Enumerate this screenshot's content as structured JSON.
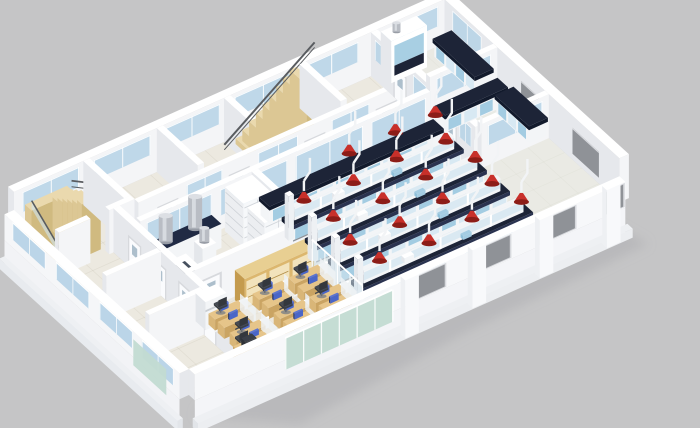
{
  "scene": {
    "type": "3d-isometric-floorplan-render",
    "setting": "laboratory-building-floor",
    "background": "#c5c5c6",
    "areas": [
      {
        "name": "main-laboratory",
        "contents": "4 island benches and 1 wall bench with dark worktops, blue base cabinet panels, reagent shelves, 19 red fume-extractor arms on white drop poles"
      },
      {
        "name": "right-lab-rooms",
        "contents": "two partitioned rooms with wall benches and a fume hood cabinet"
      },
      {
        "name": "prep-room",
        "contents": "counters with stainless extraction ducts, white storage shelving, sink counter"
      },
      {
        "name": "open-office",
        "contents": "12 cubicle desks with blue monitors and dark chairs, wooden glass-door cabinets, copier, corner workstation"
      },
      {
        "name": "circulation",
        "contents": "switchback staircase at left, straight staircase at back, corridors with glazed partition walls"
      },
      {
        "name": "envelope",
        "contents": "white exterior walls with clerestory glazing strips, gray window openings, green curtain-glass section, pilasters and plinth"
      }
    ]
  },
  "palette": {
    "bg": "#c5c5c6",
    "shadow": "#aeafb2",
    "floor": "#ece9e0",
    "tile": "#b9b4a4",
    "wallTop": "#ffffff",
    "wallA": "#f4f5f7",
    "wallB": "#e6e8ec",
    "wallC": "#d8dbe0",
    "glass": "#b5d2e6",
    "glassPale": "#cfe4f0",
    "glassGreen": "#c2dbd2",
    "benchTop": "#1d2437",
    "benchDark": "#121a2c",
    "benchSide": "#2a3350",
    "panelBlue": "#a3cce2",
    "panelBlue2": "#d8e9f3",
    "white": "#f3f5f7",
    "whiteB": "#e4e7eb",
    "red": "#c8302a",
    "redDark": "#8c1d18",
    "wood": "#ead9ae",
    "woodB": "#dcc794",
    "woodC": "#d0ba80",
    "desk": "#e6c58a",
    "deskB": "#caa463",
    "deskC": "#d9b678",
    "cab": "#dcb76e",
    "cabB": "#c49b4e",
    "cabPane": "#f3e6c2",
    "monitor": "#4a66c8",
    "monitorB": "#2c3a66",
    "monitorC": "#5a74d2",
    "chair": "#454a52",
    "chairB": "#33373d",
    "steel": "#b9bdc4",
    "steelB": "#dcdfe4",
    "steelC": "#989da6",
    "winGray": "#8f9297",
    "frame": "#d7d9dd",
    "rail": "#595c60",
    "doorWin": "#a9bcc9"
  },
  "render": {
    "meta": {
      "origin": [
        14,
        236
      ],
      "axisX": [
        1.05,
        -0.47
      ],
      "axisY": [
        0.66,
        0.6
      ],
      "W": 410,
      "D": 265,
      "wallH": 44,
      "lowH": 26,
      "ground": -26
    },
    "items": [
      {
        "t": "shadow",
        "name": "ground-shadow"
      },
      {
        "t": "floor",
        "name": "floor-slab"
      },
      {
        "t": "tint",
        "name": "corridor-floor",
        "x": 72,
        "y": 74,
        "w": 268,
        "d": 16,
        "c": "#efe9da",
        "o": 0.55
      },
      {
        "t": "tint",
        "name": "lab-floor",
        "x": 166,
        "y": 96,
        "w": 244,
        "d": 169,
        "c": "#e8ebe7",
        "o": 0.5
      },
      {
        "t": "tint",
        "name": "right-rooms-floor",
        "x": 340,
        "y": 0,
        "w": 70,
        "d": 158,
        "c": "#e8ebe7",
        "o": 0.5
      },
      {
        "t": "tint",
        "name": "office-floor",
        "x": 52,
        "y": 182,
        "w": 116,
        "d": 83,
        "c": "#ece8db",
        "o": 0.5
      },
      {
        "t": "wallx",
        "name": "back-wall",
        "x0": 0,
        "x1": 410,
        "y": 0,
        "th": 9,
        "glass": [
          [
            8,
            62
          ],
          [
            76,
            130
          ],
          [
            142,
            196
          ],
          [
            210,
            264
          ],
          [
            276,
            328
          ],
          [
            342,
            404
          ]
        ],
        "gz": [
          20,
          40
        ]
      },
      {
        "t": "wally",
        "name": "right-wall",
        "x": 410,
        "th": 9,
        "y0": 0,
        "y1": 265,
        "glass": [
          [
            12,
            56
          ]
        ],
        "gz": [
          20,
          40
        ],
        "win": [
          [
            116,
            156
          ],
          [
            194,
            234
          ]
        ],
        "winz": [
          6,
          32
        ]
      },
      {
        "t": "ustair",
        "name": "switchback-staircase",
        "x": 8,
        "y": 6
      },
      {
        "t": "wally",
        "name": "stair-hall-wall",
        "x": 66,
        "th": 6,
        "y0": 0,
        "y1": 62
      },
      {
        "t": "wallx",
        "name": "stair-hall-front-wall",
        "x0": 0,
        "x1": 30,
        "y": 68,
        "th": 6
      },
      {
        "t": "wallx",
        "name": "stair-hall-front-wall-2",
        "x0": 48,
        "x1": 72,
        "y": 68,
        "th": 6
      },
      {
        "t": "wally",
        "name": "back-room-wall-a",
        "x": 136,
        "th": 6,
        "y0": 0,
        "y1": 62
      },
      {
        "t": "wally",
        "name": "back-room-wall-b",
        "x": 200,
        "th": 6,
        "y0": 0,
        "y1": 62
      },
      {
        "t": "stairs",
        "name": "straight-staircase",
        "x": 206,
        "y": 8,
        "w": 58,
        "d": 26,
        "n": 9,
        "h": 50
      },
      {
        "t": "wally",
        "name": "back-room-wall-c",
        "x": 272,
        "th": 6,
        "y0": 0,
        "y1": 62
      },
      {
        "t": "wallx",
        "name": "corridor-wall-north",
        "x0": 72,
        "x1": 340,
        "y": 74,
        "th": 6,
        "doors": [
          100,
          168,
          240,
          308
        ],
        "glass": [
          [
            118,
            152
          ],
          [
            186,
            224
          ],
          [
            256,
            292
          ],
          [
            318,
            336
          ]
        ],
        "gz": [
          22,
          40
        ]
      },
      {
        "t": "wally",
        "name": "right-lab-partition",
        "x": 340,
        "th": 6,
        "y0": 0,
        "y1": 158,
        "doors": [
          44,
          120
        ],
        "glass": [
          [
            6,
            28
          ],
          [
            64,
            102
          ],
          [
            134,
            152
          ]
        ],
        "gz": [
          20,
          40
        ]
      },
      {
        "t": "wallx",
        "name": "right-room-divider",
        "x0": 346,
        "x1": 410,
        "y": 80,
        "th": 6,
        "glass": [
          [
            352,
            404
          ]
        ],
        "gz": [
          20,
          40
        ]
      },
      {
        "t": "wallx",
        "name": "right-room-south-wall",
        "x0": 346,
        "x1": 410,
        "y": 158,
        "th": 6,
        "glass": [
          [
            352,
            404
          ]
        ],
        "gz": [
          20,
          40
        ]
      },
      {
        "t": "fumehood",
        "name": "fume-hood-cabinet",
        "x": 348,
        "y": 2,
        "w": 34
      },
      {
        "t": "wbench",
        "name": "wall-bench-right-room-1",
        "x": 394,
        "y": 10,
        "w": 16,
        "d": 62,
        "axis": "y"
      },
      {
        "t": "wbench",
        "name": "wall-bench-right-room-2a",
        "x": 348,
        "y": 86,
        "w": 58,
        "d": 14,
        "axis": "x"
      },
      {
        "t": "wbench",
        "name": "wall-bench-right-room-2b",
        "x": 394,
        "y": 104,
        "w": 16,
        "d": 50,
        "axis": "y"
      },
      {
        "t": "wallx",
        "name": "lab-glass-wall",
        "x0": 60,
        "x1": 336,
        "y": 96,
        "th": 6,
        "glass": [
          [
            66,
            128
          ],
          [
            136,
            200
          ],
          [
            208,
            272
          ],
          [
            280,
            332
          ]
        ],
        "gz": [
          14,
          40
        ]
      },
      {
        "t": "wally",
        "name": "prep-room-wall",
        "x": 166,
        "th": 6,
        "y0": 96,
        "y1": 178
      },
      {
        "t": "box",
        "name": "prep-counter",
        "x": 60,
        "y": 102,
        "w": 64,
        "d": 15,
        "h": 24,
        "c": "counter"
      },
      {
        "t": "cyl",
        "name": "extract-duct-1",
        "x": 76,
        "y": 109,
        "z": 24,
        "r": 7,
        "h": 26
      },
      {
        "t": "cyl",
        "name": "extract-duct-2",
        "x": 104,
        "y": 109,
        "z": 24,
        "r": 7,
        "h": 32
      },
      {
        "t": "box",
        "name": "duct-column",
        "x": 86,
        "y": 136,
        "w": 13,
        "d": 13,
        "h": 36,
        "c": "white"
      },
      {
        "t": "cyl",
        "name": "extract-duct-3",
        "x": 92,
        "y": 142,
        "z": 36,
        "r": 5,
        "h": 14
      },
      {
        "t": "shelf",
        "name": "storage-shelf-1",
        "x": 138,
        "y": 100,
        "w": 26,
        "d": 28,
        "h": 44
      },
      {
        "t": "shelf",
        "name": "storage-shelf-2",
        "x": 138,
        "y": 134,
        "w": 26,
        "d": 26,
        "h": 44
      },
      {
        "t": "box",
        "name": "sink-counter",
        "x": 58,
        "y": 130,
        "w": 24,
        "d": 32,
        "h": 22,
        "c": "sink"
      },
      {
        "t": "wallx",
        "name": "office-north-wall",
        "x0": 55,
        "x1": 166,
        "y": 178,
        "th": 6,
        "doors": [
          76
        ]
      },
      {
        "t": "wcab",
        "name": "glass-door-cabinets",
        "x": 96,
        "y": 182,
        "w": 66,
        "d": 15,
        "h": 30
      },
      {
        "t": "wbench",
        "name": "lab-wall-bench",
        "x": 172,
        "y": 100,
        "w": 164,
        "d": 14,
        "axis": "x"
      },
      {
        "t": "bench",
        "name": "island-bench-1",
        "x": 172,
        "y": 132,
        "w": 164,
        "d": 15
      },
      {
        "t": "bench",
        "name": "island-bench-2",
        "x": 172,
        "y": 167,
        "w": 164,
        "d": 15
      },
      {
        "t": "bench",
        "name": "island-bench-3",
        "x": 172,
        "y": 202,
        "w": 164,
        "d": 15
      },
      {
        "t": "bench",
        "name": "island-bench-4",
        "x": 172,
        "y": 237,
        "w": 164,
        "d": 15
      },
      {
        "t": "extractors",
        "name": "fume-extractor-arms",
        "pts": [
          [
            252,
            107
          ],
          [
            296,
            107
          ],
          [
            334,
            107
          ],
          [
            190,
            137
          ],
          [
            234,
            142
          ],
          [
            278,
            137
          ],
          [
            322,
            142
          ],
          [
            196,
            172
          ],
          [
            240,
            177
          ],
          [
            284,
            172
          ],
          [
            328,
            177
          ],
          [
            190,
            207
          ],
          [
            234,
            212
          ],
          [
            278,
            207
          ],
          [
            322,
            212
          ],
          [
            196,
            242
          ],
          [
            240,
            247
          ],
          [
            284,
            242
          ],
          [
            328,
            247
          ]
        ]
      },
      {
        "t": "wally",
        "name": "left-corridor-wall",
        "x": 52,
        "th": 6,
        "y0": 68,
        "y1": 250,
        "doors": [
          100,
          138,
          176,
          214
        ]
      },
      {
        "t": "wallx",
        "name": "left-room-divider-1",
        "x0": 0,
        "x1": 52,
        "y": 140,
        "th": 6
      },
      {
        "t": "wallx",
        "name": "left-room-divider-2",
        "x0": 0,
        "x1": 52,
        "y": 205,
        "th": 6
      },
      {
        "t": "gwall",
        "name": "office-glass-partition",
        "x": 168,
        "y0": 184,
        "y1": 260,
        "h": 28
      },
      {
        "t": "box",
        "name": "office-copier",
        "x": 56,
        "y": 186,
        "w": 20,
        "d": 15,
        "h": 28,
        "c": "white"
      },
      {
        "t": "cluster",
        "name": "desk-cluster-1",
        "x": 76,
        "y": 208
      },
      {
        "t": "cluster",
        "name": "desk-cluster-2",
        "x": 118,
        "y": 208
      },
      {
        "t": "cluster",
        "name": "desk-cluster-3",
        "x": 152,
        "y": 208
      },
      {
        "t": "cluster",
        "name": "desk-cluster-4",
        "x": 76,
        "y": 240
      },
      {
        "t": "cluster",
        "name": "desk-cluster-5",
        "x": 118,
        "y": 240
      },
      {
        "t": "cluster",
        "name": "desk-cluster-6",
        "x": 152,
        "y": 240
      },
      {
        "t": "cornerdesk",
        "name": "corner-workstation",
        "x": 54,
        "y": 246
      },
      {
        "t": "fwall",
        "name": "front-wall",
        "win": [
          [
            204,
            238
          ],
          [
            266,
            300
          ],
          [
            330,
            362
          ],
          [
            392,
            408
          ]
        ],
        "winz": [
          2,
          24
        ],
        "green": [
          86,
          188
        ],
        "pilasters": [
          196,
          260,
          324,
          388
        ]
      },
      {
        "t": "lwall",
        "name": "left-wall",
        "glass": [
          [
            12,
            62
          ],
          [
            78,
            128
          ],
          [
            144,
            194
          ],
          [
            208,
            256
          ]
        ],
        "green": [
          195,
          245
        ]
      }
    ]
  }
}
